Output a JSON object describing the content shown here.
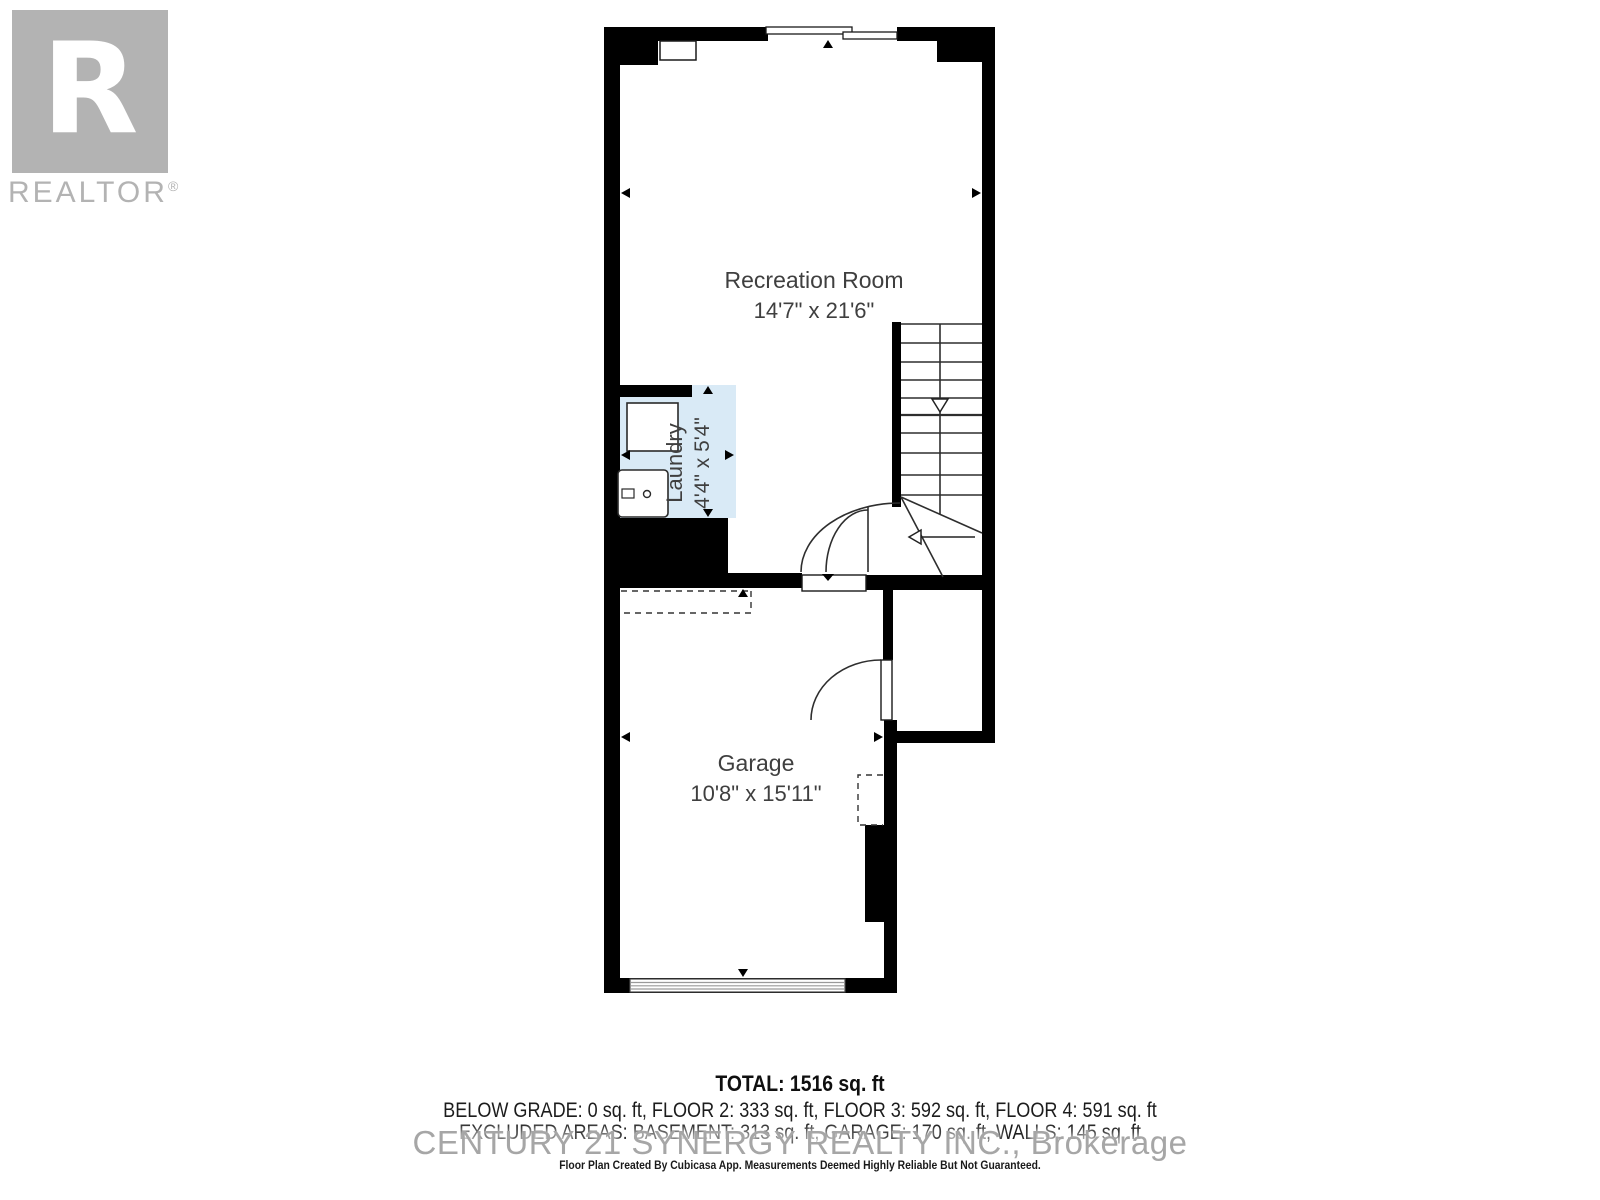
{
  "branding": {
    "logo_letter": "R",
    "logo_text": "REALTOR",
    "logo_registered": "®",
    "logo_color": "#b3b3b3"
  },
  "floor_plan": {
    "rooms": [
      {
        "name": "Recreation Room",
        "dimensions": "14'7\" x 21'6\""
      },
      {
        "name": "Laundry",
        "dimensions": "4'4\" x 5'4\""
      },
      {
        "name": "Garage",
        "dimensions": "10'8\" x 15'11\""
      }
    ],
    "colors": {
      "wall": "#000000",
      "laundry_fill": "#d9eaf6",
      "line": "#2e2e2e",
      "label_text": "#3f3f3f"
    }
  },
  "summary": {
    "total": "TOTAL: 1516 sq. ft",
    "floors": "BELOW GRADE: 0 sq. ft, FLOOR 2: 333 sq. ft, FLOOR 3: 592 sq. ft, FLOOR 4: 591 sq. ft",
    "excluded": "EXCLUDED AREAS: BASEMENT: 313 sq. ft, GARAGE: 170 sq. ft, WALLS: 145 sq. ft",
    "watermark": "CENTURY 21 SYNERGY REALTY INC., Brokerage",
    "disclaimer": "Floor Plan Created By Cubicasa App. Measurements Deemed Highly Reliable But Not Guaranteed."
  }
}
